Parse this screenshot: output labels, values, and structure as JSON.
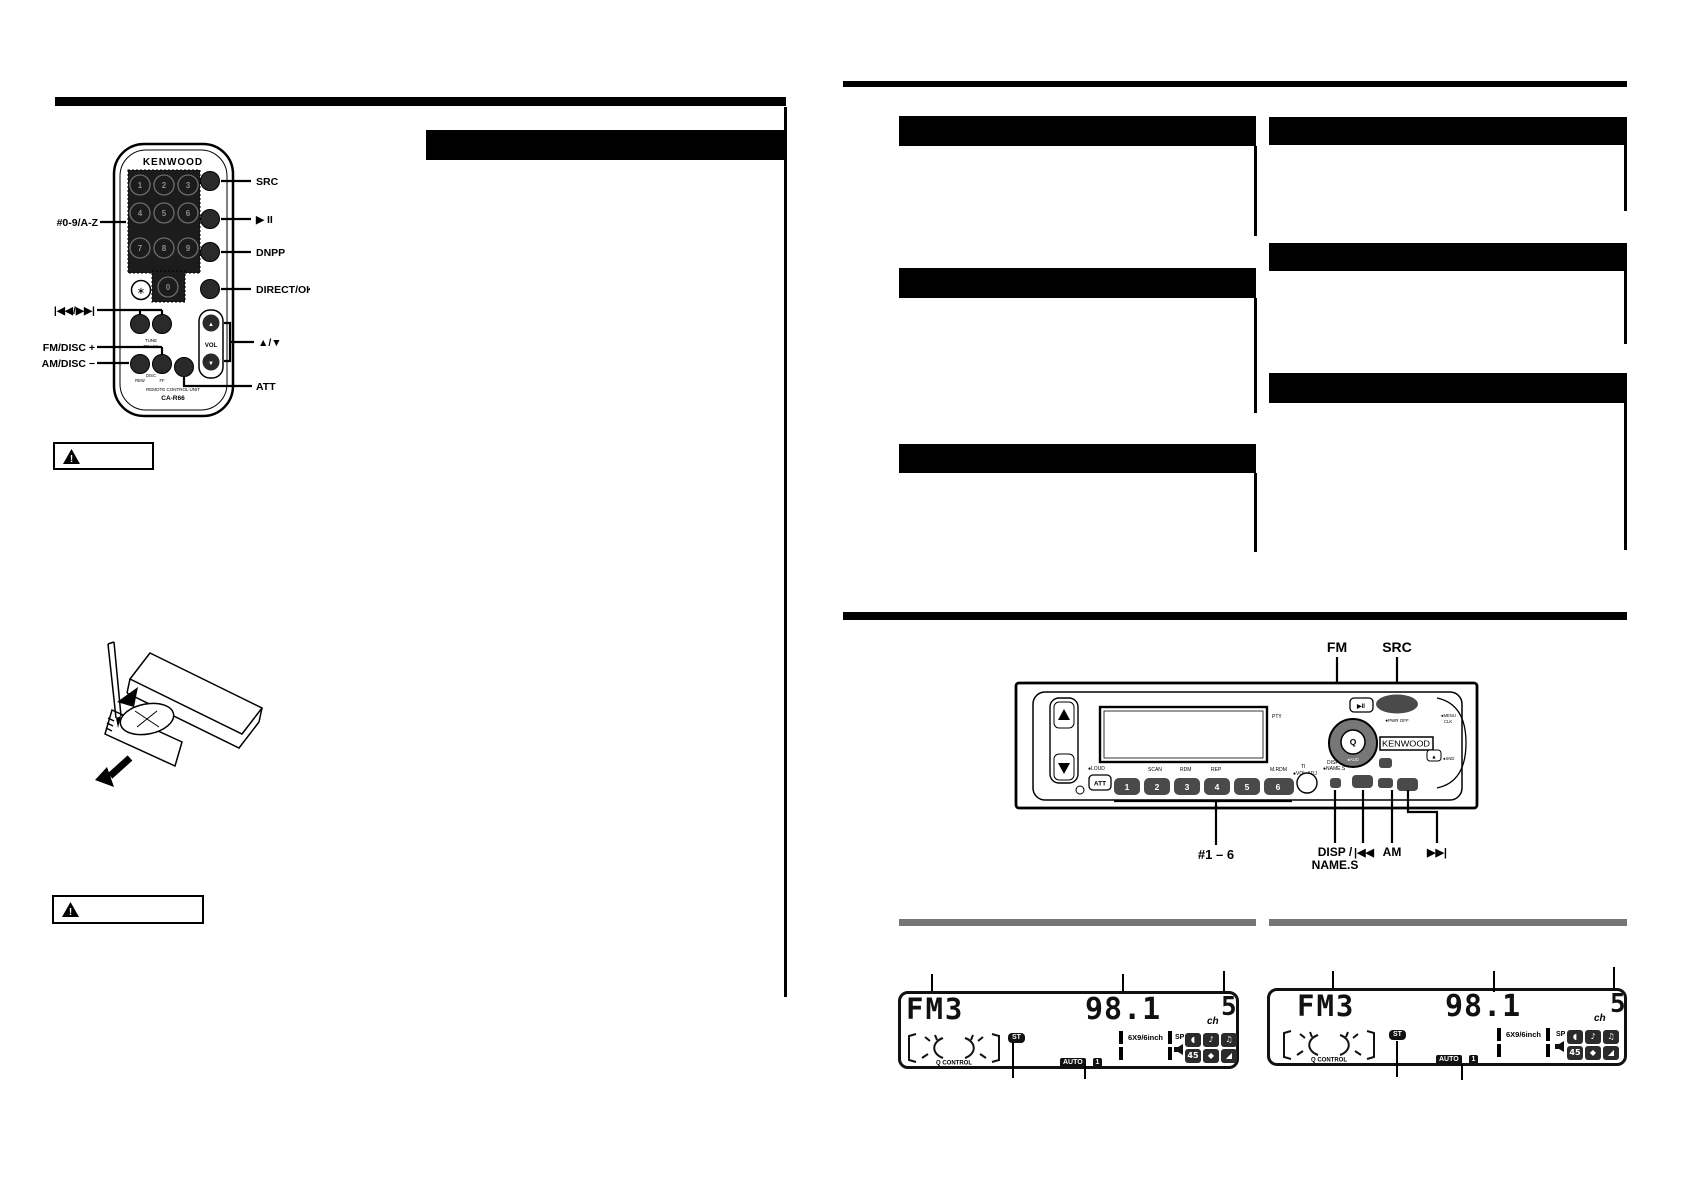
{
  "left_page": {
    "remote": {
      "brand": "KENWOOD",
      "keys": [
        "1",
        "2",
        "3",
        "4",
        "5",
        "6",
        "7",
        "8",
        "9",
        "0"
      ],
      "asterisk": "∗",
      "vol": "VOL",
      "tune": "TUNE",
      "track": "TRACK",
      "disc": "DISC",
      "rew": "REW",
      "ff": "FF",
      "footer_line1": "REMOTE CONTROL UNIT",
      "footer_line2": "CA-R66",
      "callouts_left": [
        "#0-9/A-Z",
        "|◀◀/▶▶|",
        "FM/DISC +",
        "AM/DISC −"
      ],
      "callouts_right": [
        "SRC",
        "▶ II",
        "DNPP",
        "DIRECT/OK",
        "▲/▼",
        "ATT"
      ]
    }
  },
  "right_page": {
    "head_unit": {
      "brand": "KENWOOD",
      "callouts_top": [
        "FM",
        "SRC"
      ],
      "callouts_bottom": [
        "#1 – 6",
        "DISP /",
        "NAME.S",
        "|◀◀",
        "AM",
        "▶▶|"
      ],
      "att": "ATT",
      "presets": [
        "1",
        "2",
        "3",
        "4",
        "5",
        "6"
      ],
      "play_pause": "▶II",
      "labels": {
        "loud": "●LOUD",
        "scan": "SCAN",
        "rdm": "RDM",
        "rep": "REP",
        "mrdm": "M.RDM",
        "ti": "TI",
        "vol_adj": "●VOL.ADJ",
        "disp": "DISP",
        "name_s": "●NAME.S",
        "pty": "PTY",
        "pwr_off": "●PWR OFF",
        "aud": "●AUD",
        "menu": "●MENU",
        "clk": "CLK",
        "snd": "●SND",
        "eject": "▲"
      }
    },
    "display": {
      "band": "FM3",
      "frequency": "98.1",
      "ch_label": "ch",
      "channel": "5",
      "stereo": "ST",
      "auto": "AUTO",
      "auto_num": "1",
      "q_control": "Q CONTROL",
      "speaker_size": "6X9/6inch",
      "sp": "SP",
      "icons": [
        "◖",
        "♪",
        "♫",
        "45",
        "◆",
        "◢"
      ]
    }
  }
}
